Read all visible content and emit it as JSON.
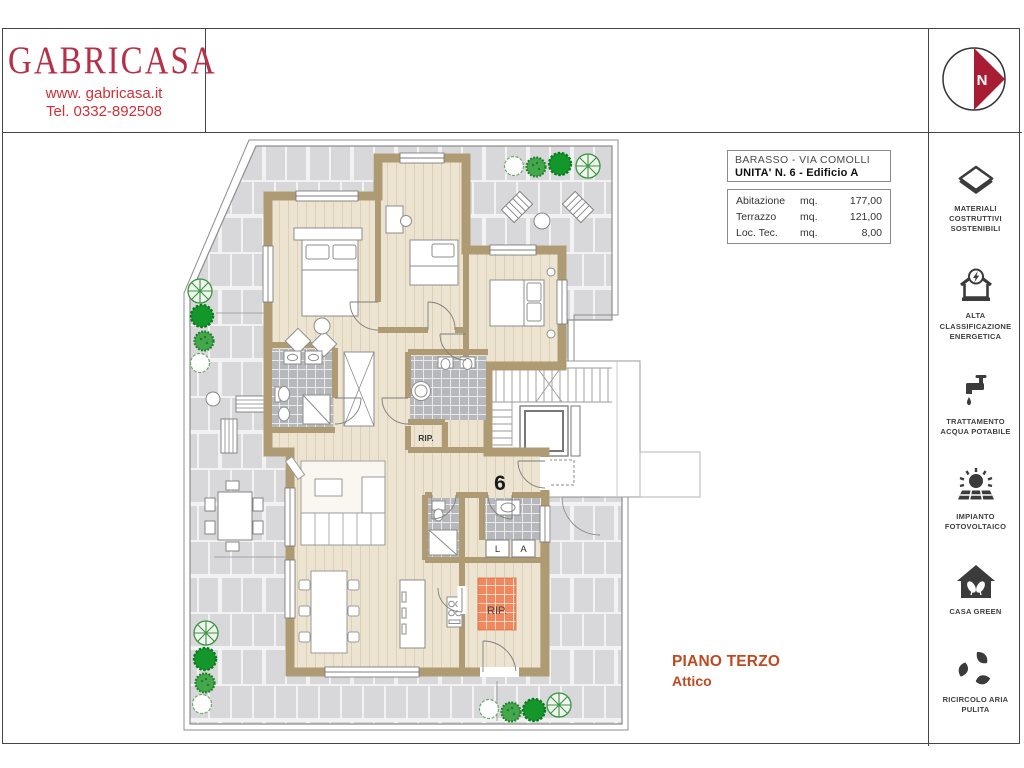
{
  "header": {
    "logo": {
      "name": "GABRICASA",
      "website": "www. gabricasa.it",
      "phone": "Tel. 0332-892508"
    },
    "compass": {
      "label": "N"
    }
  },
  "info_box": {
    "location": "BARASSO - VIA COMOLLI",
    "unit": "UNITA' N. 6 - Edificio A"
  },
  "area_table": {
    "rows": [
      {
        "label": "Abitazione",
        "unit": "mq.",
        "value": "177,00"
      },
      {
        "label": "Terrazzo",
        "unit": "mq.",
        "value": "121,00"
      },
      {
        "label": "Loc. Tec.",
        "unit": "mq.",
        "value": "8,00"
      }
    ]
  },
  "floor_label": {
    "title": "PIANO TERZO",
    "subtitle": "Attico"
  },
  "plan": {
    "unit_number": "6",
    "storage_label_1": "RIP.",
    "storage_label_2": "RIP.",
    "washer_label": "L",
    "dryer_label": "A"
  },
  "sidebar": {
    "items": [
      {
        "icon": "sustainable-materials-icon",
        "label": "MATERIALI COSTRUTTIVI SOSTENIBILI"
      },
      {
        "icon": "energy-class-icon",
        "label": "ALTA CLASSIFICAZIONE ENERGETICA"
      },
      {
        "icon": "water-treatment-icon",
        "label": "TRATTAMENTO ACQUA POTABILE"
      },
      {
        "icon": "photovoltaic-icon",
        "label": "IMPIANTO FOTOVOLTAICO"
      },
      {
        "icon": "casa-green-icon",
        "label": "CASA GREEN"
      },
      {
        "icon": "air-recirculation-icon",
        "label": "RICIRCOLO ARIA PULITA"
      }
    ]
  },
  "colors": {
    "brand_crimson": "#b43148",
    "contact_red": "#d22f38",
    "compass_red": "#a81d33",
    "accent_rust": "#bf4a21",
    "wall_tan": "#ae9b74",
    "floor_cream": "#ece4d1",
    "terrace_tile": "#d8d8da",
    "bath_tile": "#b7b8bc",
    "storage_tile": "#f0875d",
    "tree_green": "#2f9b3a",
    "icon_dark": "#3b3b3b"
  }
}
